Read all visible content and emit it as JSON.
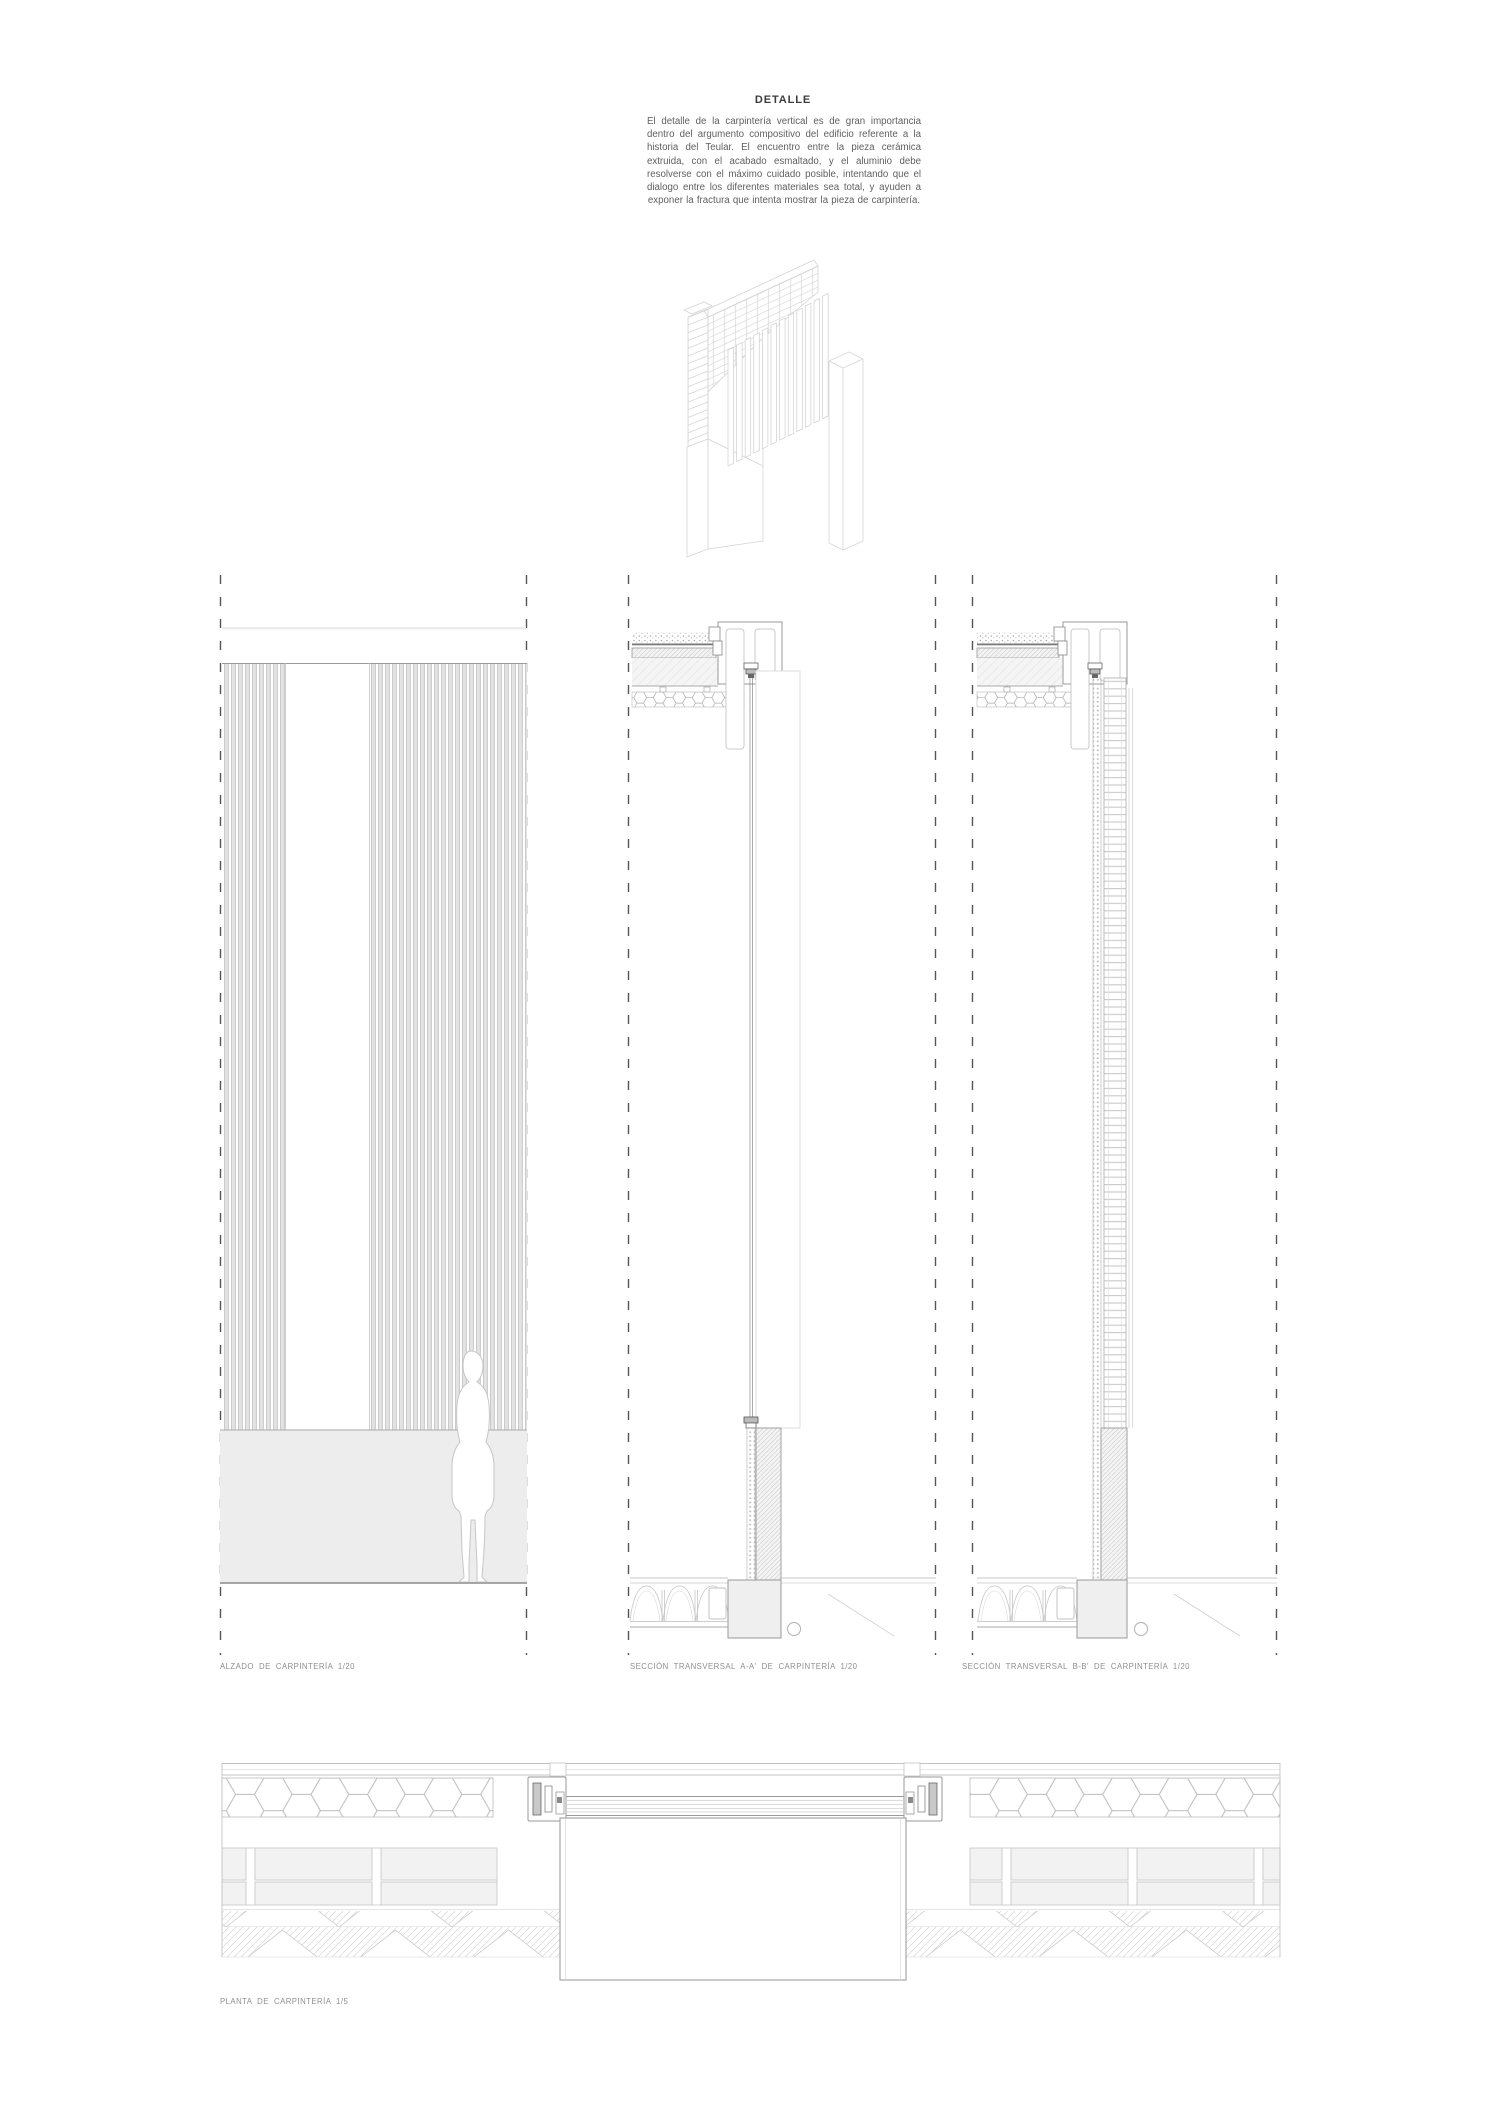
{
  "header": {
    "title": "DETALLE",
    "paragraph": "El detalle de la carpintería vertical es de gran importancia dentro del argumento compositivo del edificio referente a la historia del Teular. El encuentro entre la pieza cerámica extruida, con el acabado esmaltado, y el aluminio debe resolverse con el máximo cuidado posible, intentando que el dialogo entre los diferentes materiales sea total, y ayuden a exponer la fractura que intenta mostrar la pieza de carpintería."
  },
  "labels": {
    "elevation": "ALZADO DE CARPINTERÍA 1/20",
    "section_aa": "SECCIÓN TRANSVERSAL A-A' DE CARPINTERÍA 1/20",
    "section_bb": "SECCIÓN TRANSVERSAL B-B' DE CARPINTERÍA 1/20",
    "plan": "PLANTA DE CARPINTERÍA 1/5"
  },
  "colors": {
    "dash_line": "#555555",
    "line_light": "#d6d6d6",
    "line_mid": "#aaaaaa",
    "fill_light": "#efefef",
    "stripe_fill": "#e3e3e3",
    "label_text": "#8f8f8f",
    "body_text": "#5f5f5f"
  }
}
